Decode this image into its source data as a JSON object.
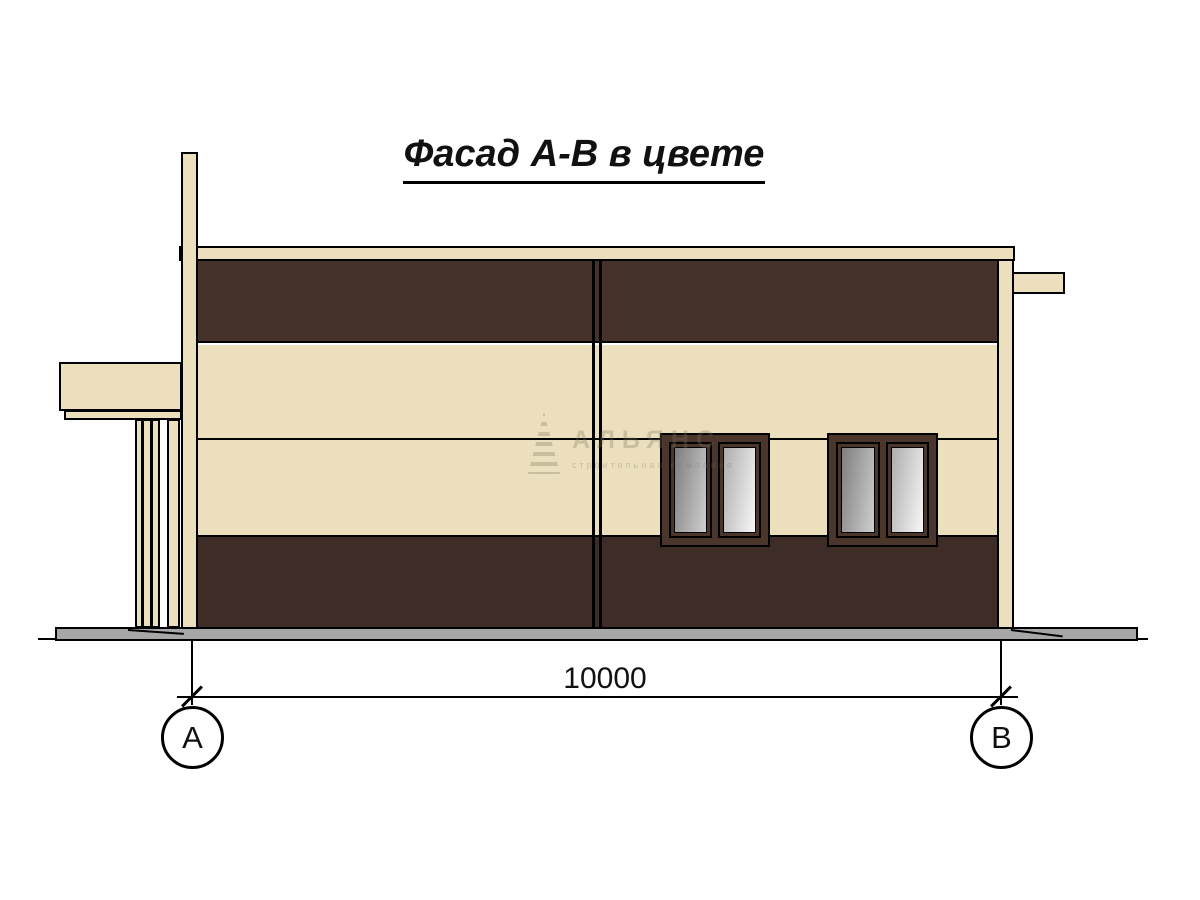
{
  "title": {
    "text": "Фасад А-В в цвете"
  },
  "dimension": {
    "value": "10000"
  },
  "axes": {
    "left": "А",
    "right": "В"
  },
  "watermark": {
    "name": "АЛЬЯНС",
    "tagline": "строительная компания"
  },
  "colors": {
    "cream": "#ECDFBE",
    "brown-top": "#44322B",
    "brown-bottom": "#3E2D27",
    "frame-brown": "#4B362C",
    "ground-gray": "#A7A7A7",
    "glass-dark": "#7E7E7E",
    "glass-light": "#F8F8F8"
  }
}
